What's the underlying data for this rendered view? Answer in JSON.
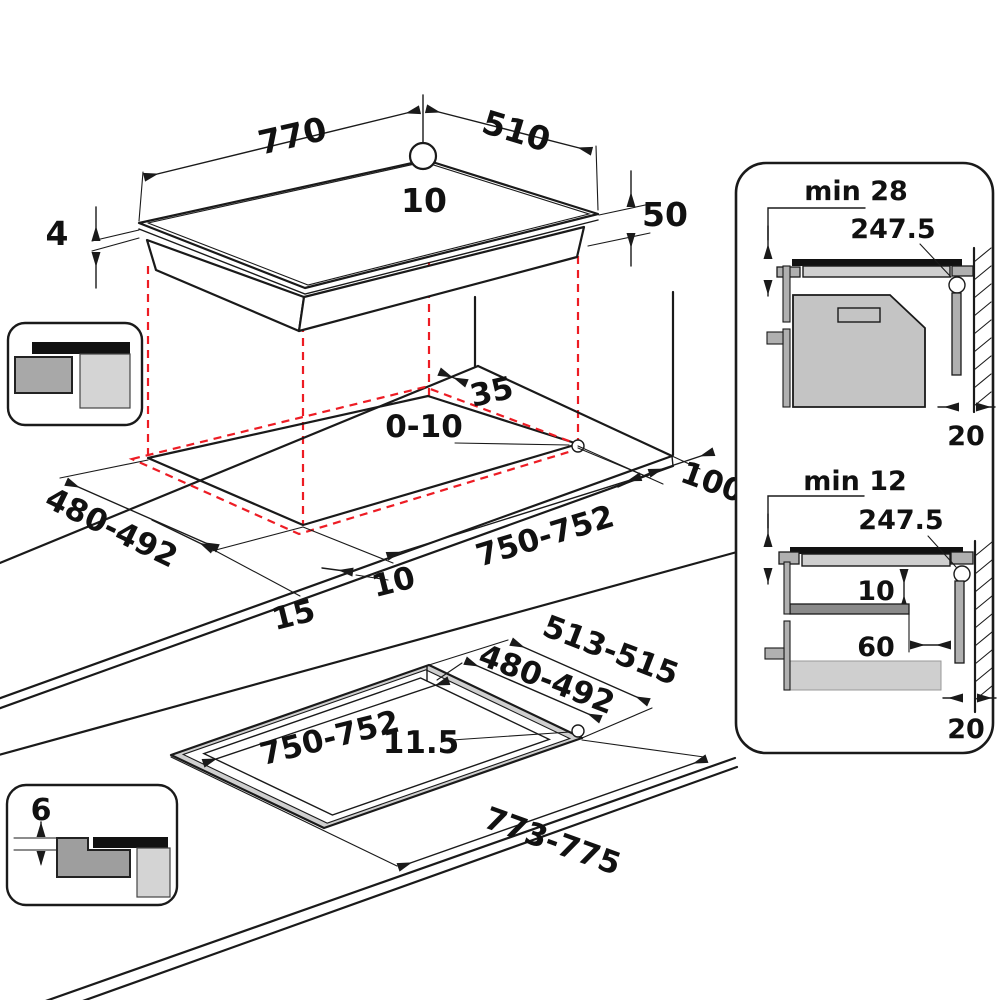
{
  "diagram_title": "hob-installation-dimensions",
  "colors": {
    "line": "#1a1a1a",
    "projection_red": "#ed1c24",
    "gray_light": "#d4d4d4",
    "gray_mid": "#b0b0b0",
    "gray_dark": "#8a8a8a",
    "black_fill": "#111111"
  },
  "hob_view": {
    "width": "770",
    "depth": "510",
    "hole_offset": "10",
    "glass_thickness": "4",
    "body_height": "50"
  },
  "cutout_view": {
    "rear_gap": "35",
    "corner_gap": "0-10",
    "cutout_depth": "480-492",
    "cutout_width": "750-752",
    "side_clearance": "100",
    "front_edge_gap": "15",
    "front_edge_gap2": "10"
  },
  "flush_view": {
    "frame_depth": "513-515",
    "cutout_depth": "480-492",
    "cutout_width": "750-752",
    "corner_radius": "11.5",
    "frame_width": "773-775"
  },
  "side_view_top": {
    "title": "min 28",
    "hole_center_distance": "247.5",
    "wall_clearance": "20"
  },
  "side_view_bottom": {
    "title": "min 12",
    "hole_center_distance": "247.5",
    "shelf_clearance": "10",
    "shelf_setback": "60",
    "wall_clearance": "20"
  },
  "flush_inset": {
    "rebate_depth": "6"
  }
}
